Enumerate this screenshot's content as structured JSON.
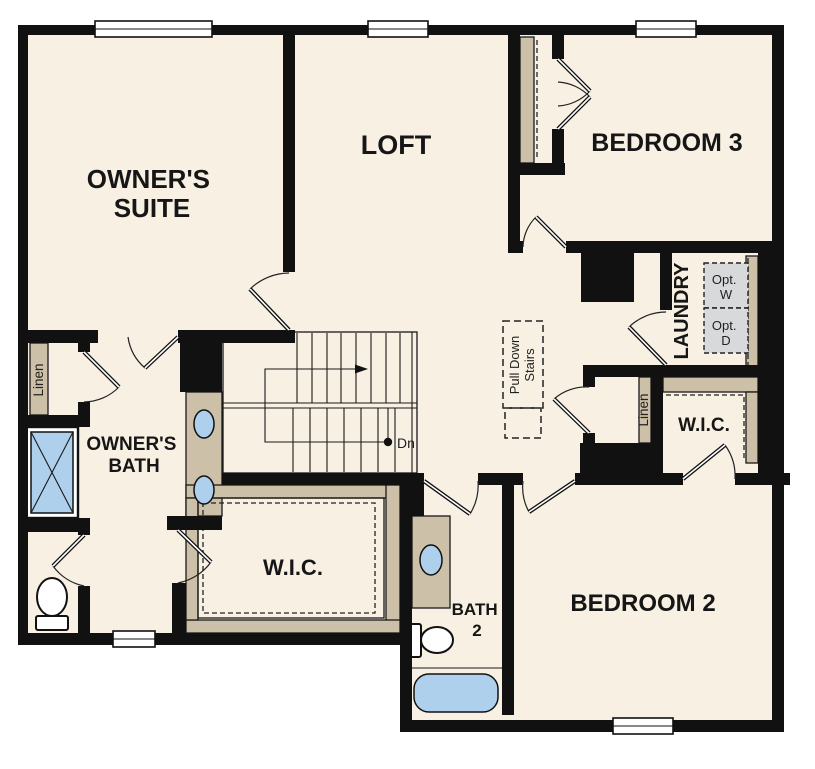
{
  "labels": {
    "owners_suite_1": "OWNER'S",
    "owners_suite_2": "SUITE",
    "loft": "LOFT",
    "bedroom3": "BEDROOM 3",
    "laundry": "LAUNDRY",
    "opt_w_1": "Opt.",
    "opt_w_2": "W",
    "opt_d_1": "Opt.",
    "opt_d_2": "D",
    "linen_owner": "Linen",
    "owners_bath_1": "OWNER'S",
    "owners_bath_2": "BATH",
    "wic_owner": "W.I.C.",
    "pull_down_1": "Pull Down",
    "pull_down_2": "Stairs",
    "down": "Dn",
    "linen_hall": "Linen",
    "wic_bedroom2": "W.I.C.",
    "bath2_1": "BATH",
    "bath2_2": "2",
    "bedroom2": "BEDROOM 2"
  },
  "colors": {
    "floor": "#f7f0e3",
    "wall": "#111111",
    "tan": "#cdc0a8",
    "blue": "#aed0ec",
    "gray": "#d7d9da"
  }
}
